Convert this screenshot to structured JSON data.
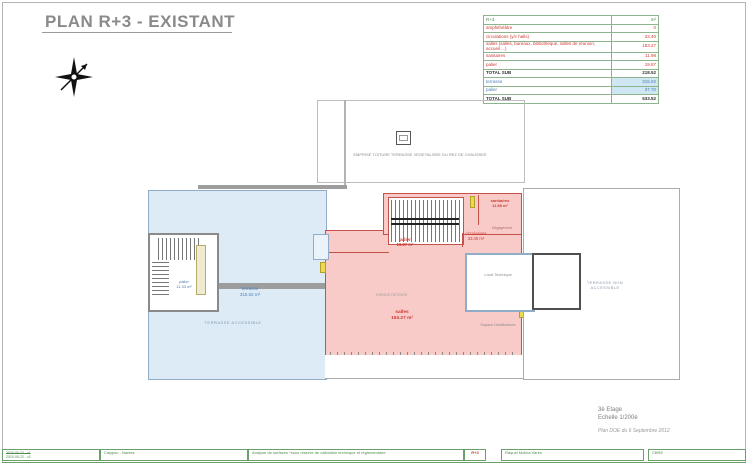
{
  "title": "PLAN R+3 - EXISTANT",
  "colors": {
    "sub_red": "#cc3a35",
    "pink_fill": "#f8cbc8",
    "terrace_text_blue": "#4d7fb5",
    "terrace_fill": "#ddebf6",
    "table_border_green": "#8db58d",
    "footer_green": "#4e8c4e",
    "title_gray": "#8a8a8a"
  },
  "area_table": {
    "header": {
      "col1": "R+3",
      "col2": "m²"
    },
    "rows": [
      {
        "label": "amphithéâtre",
        "value": "0"
      },
      {
        "label": "circulations (y/c halls)",
        "value": "33.40"
      },
      {
        "label": "salles (salles, bureaux, bibliothèque, salles de réunion, accueil ...)",
        "value": "153.27"
      },
      {
        "label": "sanitaires",
        "value": "11.98"
      },
      {
        "label": "palier",
        "value": "19.87"
      },
      {
        "label": "TOTAL SUB",
        "value": "218.52"
      },
      {
        "label": "terrasse",
        "value": "315.02"
      },
      {
        "label": "palier",
        "value": "37.70"
      },
      {
        "label": "TOTAL SUB",
        "value": "533.52"
      }
    ]
  },
  "plan": {
    "roof_label": "EMPRISE TOITURE TERRASSE VEGETALISEE DU REZ DE CHAUSSEE",
    "terrace2_label": "EMPRISE TERRASSE NON ACCESSIBLE DU 2ème ETAGE",
    "stairs_palier": {
      "name": "palier",
      "area": "11.33 m²"
    },
    "terrasse": {
      "name": "terrasse",
      "area": "315.02 m²"
    },
    "terrasse_accessible": "TERRASSE ACCESSIBLE",
    "palier": {
      "name": "palier",
      "area": "19.87 m²"
    },
    "circulations": {
      "name": "circulations",
      "area": "33.40 m²"
    },
    "sanitaires": {
      "name": "sanitaires",
      "area": "11.98 m²"
    },
    "salles": {
      "name": "salles",
      "area": "153.27 m²"
    },
    "degagement": "Dégagement",
    "espace_detente": "ESPACE DETENTE",
    "espace_distributeurs": "Espace Distributeurs",
    "local_technique": "Local Technique",
    "terrasse_non_accessible": "TERRASSE NON ACCESSIBLE"
  },
  "titleblock": {
    "floor": "3è Etage",
    "scale": "Echelle 1/200è",
    "doc": "Plan DOE du 6 Septembre 2012"
  },
  "footer": {
    "version_old": "2020-05-22 - v1",
    "version": "2020-05-22 - v2",
    "project": "Calypso - Nantes",
    "note": "Analyse de surfaces *sous réserve de validation technique et réglementaire",
    "level": "R+3",
    "author": "Raquel Molina Varés",
    "company": "CBRE"
  }
}
